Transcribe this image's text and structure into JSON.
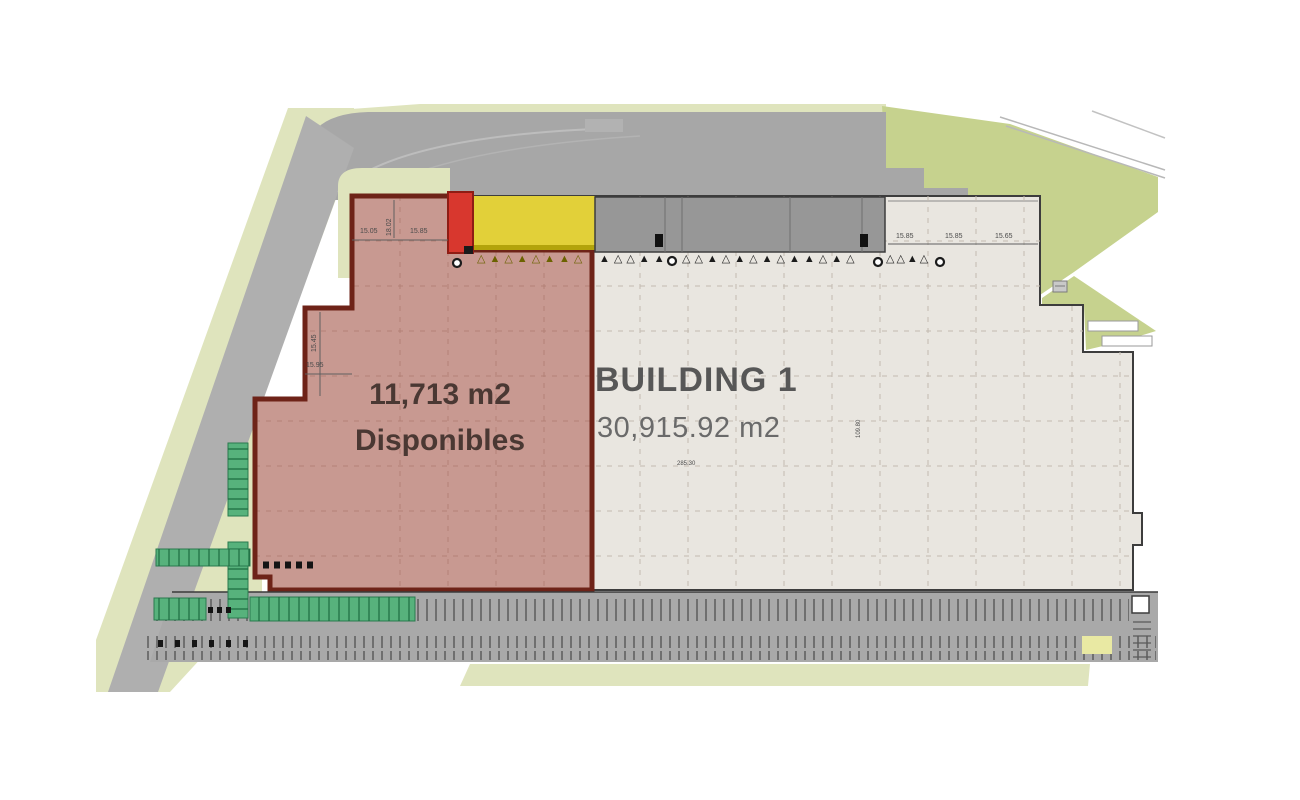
{
  "building": {
    "name": "BUILDING 1",
    "area": "30,915.92 m2"
  },
  "available": {
    "area": "11,713 m2",
    "label": "Disponibles"
  },
  "dimensions": {
    "top_bay_w1": "15.05",
    "top_bay_w2": "15.85",
    "top_bay_depth": "18.02",
    "left_bay_depth": "15.45",
    "left_bay_w": "15.95",
    "tr_bay1": "15.85",
    "tr_bay2": "15.85",
    "tr_bay3": "15.65",
    "total_width": "285.30",
    "total_depth": "109.80"
  },
  "markers": {
    "entry_row_yellow": "△▲△▲△▲▲△",
    "dock_row_a": "▲△△▲▲",
    "dock_row_b": "△△▲△▲△▲△▲▲△▲△",
    "dock_row_c": "△△▲△"
  },
  "colors": {
    "pale_green": "#dfe4bd",
    "sage_green": "#c6d28e",
    "court_gray": "#a7a7a7",
    "road_gray": "#afafaf",
    "band_gray": "#a9a9a9",
    "dock_gray": "#979797",
    "building_fill": "#e9e6e0",
    "building_stroke": "#3d3d3d",
    "grid_line": "#c3bab0",
    "available_overlay": "rgba(160,60,48,0.45)",
    "available_outline": "#6e2318",
    "highlight_red": "#d8372e",
    "highlight_red_border": "#8f1c14",
    "highlight_yellow": "#e2d039",
    "highlight_yellow_dark": "#b3a30b",
    "parking_green": "#57b27c",
    "parking_green_line": "#1c6b40",
    "parking_green_stroke": "#2a7a4e",
    "tick_gray": "#4f4f4f",
    "pale_yellow": "#e9e9a3",
    "text_dark": "#4a3833",
    "text_gray": "#575757",
    "text_gray2": "#6a6a6a",
    "dim_text": "#4a4a4a"
  }
}
